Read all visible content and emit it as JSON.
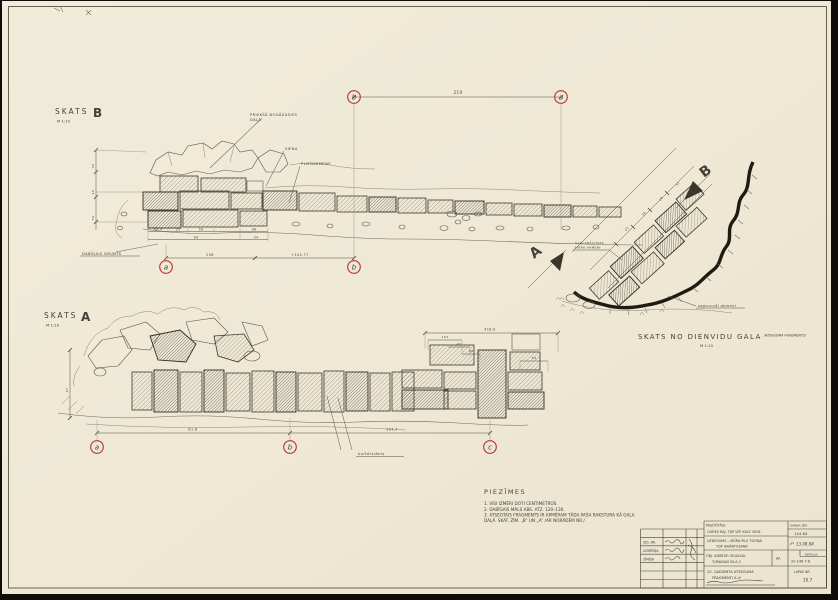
{
  "palette": {
    "paper": "#efe9d6",
    "ink": "#45413a",
    "pencil": "#8b8573",
    "red": "#b8322c",
    "edge": "#0e0d09"
  },
  "views": {
    "b": {
      "title": "SKATS",
      "letter": "B",
      "scale": "M 1:10"
    },
    "a": {
      "title": "SKATS",
      "letter": "A",
      "scale": "M 1:10"
    },
    "south": {
      "title": "SKATS NO DIENVIDU GALA",
      "suffix": "/ATSEGUMA FRAGMENTS/",
      "scale": "M 1:10"
    }
  },
  "notes": {
    "heading": "PIEZĪMES",
    "lines": [
      "1. VISI IZMĒRI DOTI CENTIMETROS.",
      "2. DABĪGAIS MĀLS ABS. ATZ. 120–130.",
      "3. ATSEGTAIS FRAGMENTS IR APMĒRAM TĀDA PAŠA RAKSTURA KĀ GALA",
      "    DAĻĀ. SKAT. ZĪM. „B” UN „A” /AR NORĀDĒM NR./"
    ]
  },
  "titleblock": {
    "left": {
      "r1": "IZG. NR.",
      "r2": "UZMĒRĪJA",
      "r3": "ZĪMĒJA"
    },
    "client_label": "PASŪTĪTĀJS:",
    "client_value": "OGRES RAJ. TDP IZP. KULT. NOD.",
    "task_line1": "UZDEVUMS – MŪRA PILS TILTIŅA",
    "task_line2": "TDP IEKĀRTOŠANA",
    "address_label": "OBJ. ADRESE: SIGULDA,",
    "address_value": "TURAIDAS IELA 2",
    "address_sub": "PP.",
    "object_line1": "20. GADSIMTA ATSEGUMA",
    "object_line2": "FRAGMENTI A–X",
    "code_label": "DARBA ZĪM.",
    "code_value": "144-84",
    "date_value": "13.08.84.",
    "detail_label": "DETAĻAS",
    "detail_value": "20.146.7-6",
    "sheet_label": "LAPAS NR.",
    "sheet_value": "10.7"
  },
  "markers": [
    {
      "name": "grid-marker-b-top",
      "letter": "b",
      "x": 354,
      "y": 97
    },
    {
      "name": "grid-marker-a-top",
      "letter": "a",
      "x": 561,
      "y": 97
    },
    {
      "name": "grid-marker-a-viewb",
      "letter": "a",
      "x": 166,
      "y": 267
    },
    {
      "name": "grid-marker-b-viewb",
      "letter": "b",
      "x": 354,
      "y": 267
    },
    {
      "name": "grid-marker-a-viewa",
      "letter": "a",
      "x": 97,
      "y": 447
    },
    {
      "name": "grid-marker-b-viewa",
      "letter": "b",
      "x": 290,
      "y": 447
    },
    {
      "name": "grid-marker-c-viewa",
      "letter": "c",
      "x": 490,
      "y": 447
    }
  ],
  "svg_labels": [
    {
      "name": "label-fallen-part-line1",
      "text": "PRIEKŠĀ NOGĀZUSIES",
      "x": 250,
      "y": 116,
      "s": 3.6
    },
    {
      "name": "label-fallen-part-line2",
      "text": "DAĻA",
      "x": 250,
      "y": 121,
      "s": 3.6
    },
    {
      "name": "label-siena",
      "text": "SIENA",
      "x": 285,
      "y": 150,
      "s": 3.6
    },
    {
      "name": "label-plienakmens",
      "text": "PLIENAKMENS",
      "x": 301,
      "y": 165,
      "s": 3.6
    },
    {
      "name": "label-dabigais-grunts",
      "text": "DABĪGAIS GRUNTS",
      "x": 82,
      "y": 255,
      "s": 3.6
    },
    {
      "name": "dim-219",
      "text": "219",
      "x": 458,
      "y": 94,
      "s": 4,
      "a": "middle"
    },
    {
      "name": "dim-40-4",
      "text": "40,4",
      "x": 158,
      "y": 230.5,
      "s": 3.2,
      "a": "middle"
    },
    {
      "name": "dim-25",
      "text": "25",
      "x": 178,
      "y": 230.5,
      "s": 3.2,
      "a": "middle"
    },
    {
      "name": "dim-59",
      "text": "59",
      "x": 201,
      "y": 230.5,
      "s": 3.2,
      "a": "middle"
    },
    {
      "name": "dim-96",
      "text": "96",
      "x": 254,
      "y": 230.5,
      "s": 3.2,
      "a": "middle"
    },
    {
      "name": "dim-94",
      "text": "94",
      "x": 196,
      "y": 238.5,
      "s": 3.2,
      "a": "middle"
    },
    {
      "name": "dim-34",
      "text": "34",
      "x": 256,
      "y": 238.5,
      "s": 3.2,
      "a": "middle"
    },
    {
      "name": "dim-256",
      "text": "256",
      "x": 210,
      "y": 256,
      "s": 3.4,
      "a": "middle"
    },
    {
      "name": "dim-elevation",
      "text": "+142,77",
      "x": 300,
      "y": 256,
      "s": 3.4,
      "a": "middle"
    },
    {
      "name": "dim-30",
      "text": "30",
      "x": 94,
      "y": 166,
      "s": 3,
      "r": -90,
      "a": "middle"
    },
    {
      "name": "dim-20",
      "text": "20",
      "x": 94,
      "y": 192,
      "s": 3,
      "r": -90,
      "a": "middle"
    },
    {
      "name": "dim-50",
      "text": "50",
      "x": 94,
      "y": 218,
      "s": 3,
      "r": -90,
      "a": "middle"
    },
    {
      "name": "dim-416-9",
      "text": "416,9",
      "x": 490,
      "y": 330.5,
      "s": 3.2,
      "a": "middle"
    },
    {
      "name": "dim-103",
      "text": "103",
      "x": 445,
      "y": 338,
      "s": 3,
      "a": "middle"
    },
    {
      "name": "dim-47",
      "text": "47",
      "x": 459,
      "y": 345,
      "s": 3,
      "a": "middle"
    },
    {
      "name": "dim-28",
      "text": "28",
      "x": 471,
      "y": 352,
      "s": 3,
      "a": "middle"
    },
    {
      "name": "dim-54",
      "text": "54",
      "x": 534,
      "y": 359,
      "s": 3,
      "a": "middle"
    },
    {
      "name": "label-kulturslanis",
      "text": "kultūrslānis",
      "x": 358,
      "y": 455,
      "s": 3.8,
      "i": 1
    },
    {
      "name": "dim-81-6",
      "text": "81,6",
      "x": 193,
      "y": 430.5,
      "s": 3.4,
      "a": "middle"
    },
    {
      "name": "dim-197-7",
      "text": "197,7",
      "x": 392,
      "y": 430.5,
      "s": 3.4,
      "a": "middle"
    },
    {
      "name": "dim-45",
      "text": "45",
      "x": 68,
      "y": 390,
      "s": 3,
      "r": -90,
      "a": "middle"
    },
    {
      "name": "plan-note-line1",
      "text": "SAGLABĀJUŠIES",
      "x": 575,
      "y": 244,
      "s": 3
    },
    {
      "name": "plan-note-line2",
      "text": "MŪRA AKMEŅI",
      "x": 575,
      "y": 248.5,
      "s": 3
    },
    {
      "name": "label-sagruvusi-akmeni",
      "text": "sagruvuši akmeņi",
      "x": 698,
      "y": 307,
      "s": 3.6,
      "i": 1
    },
    {
      "name": "plan-dim-25",
      "text": "25",
      "x": 626,
      "y": 231,
      "s": 3,
      "r": -45
    },
    {
      "name": "plan-dim-34",
      "text": "34",
      "x": 643,
      "y": 216,
      "s": 3,
      "r": -45
    },
    {
      "name": "plan-dim-28",
      "text": "28",
      "x": 660,
      "y": 201,
      "s": 3,
      "r": -45
    },
    {
      "name": "plan-dim-47",
      "text": "47",
      "x": 677,
      "y": 186,
      "s": 3,
      "r": -45
    },
    {
      "name": "section-letter-b",
      "text": "B",
      "x": 704,
      "y": 178,
      "s": 14,
      "w": "bold",
      "r": -38
    },
    {
      "name": "section-letter-a",
      "text": "A",
      "x": 534,
      "y": 259,
      "s": 14,
      "w": "bold",
      "r": -38
    }
  ]
}
